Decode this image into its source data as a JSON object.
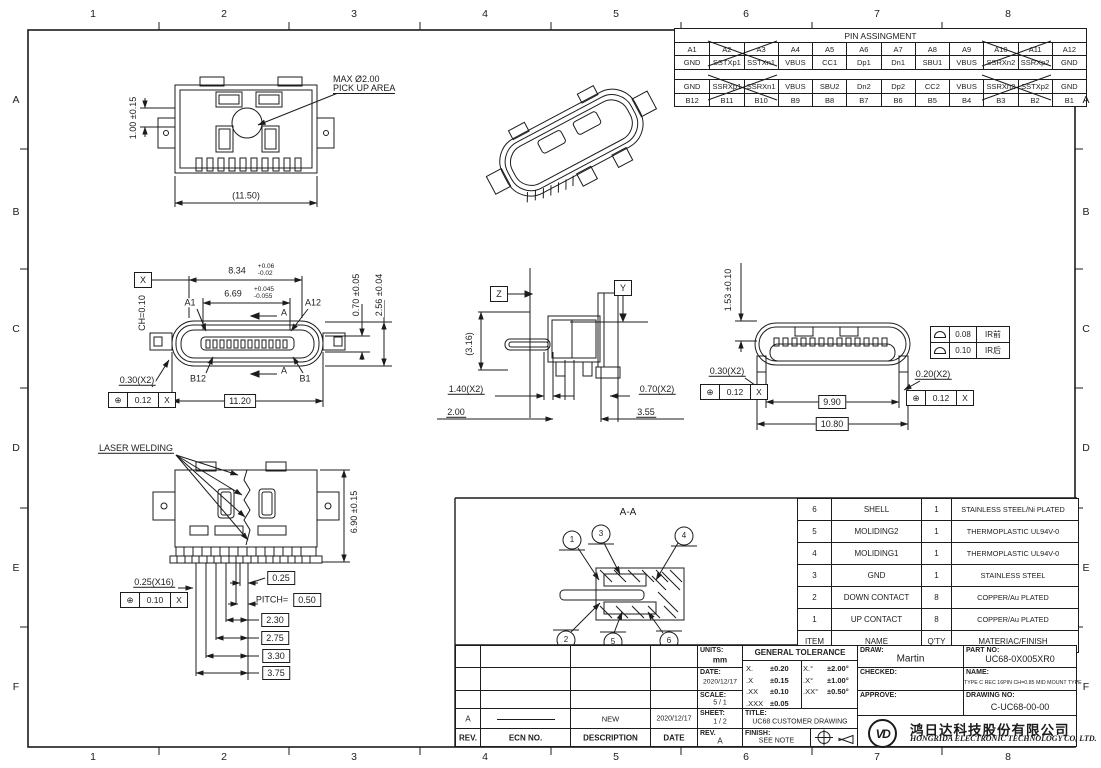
{
  "colors": {
    "line": "#1c1c1c",
    "bg": "#ffffff"
  },
  "border": {
    "cols": [
      "1",
      "2",
      "3",
      "4",
      "5",
      "6",
      "7",
      "8"
    ],
    "rows": [
      "A",
      "B",
      "C",
      "D",
      "E",
      "F"
    ]
  },
  "pin_table": {
    "title": "PIN ASSINGMENT",
    "top_pins": [
      "A1",
      "A2",
      "A3",
      "A4",
      "A5",
      "A6",
      "A7",
      "A8",
      "A9",
      "A10",
      "A11",
      "A12"
    ],
    "top_signals": [
      "GND",
      "SSTXp1",
      "SSTXn1",
      "VBUS",
      "CC1",
      "Dp1",
      "Dn1",
      "SBU1",
      "VBUS",
      "SSRXn2",
      "SSRXp2",
      "GND"
    ],
    "bottom_signals": [
      "GND",
      "SSRXp1",
      "SSRXn1",
      "VBUS",
      "SBU2",
      "Dn2",
      "Dp2",
      "CC2",
      "VBUS",
      "SSRXn2",
      "SSTXp2",
      "GND"
    ],
    "bottom_pins": [
      "B12",
      "B11",
      "B10",
      "B9",
      "B8",
      "B7",
      "B6",
      "B5",
      "B4",
      "B3",
      "B2",
      "B1"
    ]
  },
  "bom": {
    "headers": [
      "ITEM",
      "NAME",
      "Q'TY",
      "MATERIAC/FINISH"
    ],
    "rows": [
      [
        "6",
        "SHELL",
        "1",
        "STAINLESS STEEL/Ni PLATED"
      ],
      [
        "5",
        "MOLIDING2",
        "1",
        "THERMOPLASTIC  UL94V-0"
      ],
      [
        "4",
        "MOLIDING1",
        "1",
        "THERMOPLASTIC  UL94V-0"
      ],
      [
        "3",
        "GND",
        "1",
        "STAINLESS STEEL"
      ],
      [
        "2",
        "DOWN CONTACT",
        "8",
        "COPPER/Au PLATED"
      ],
      [
        "1",
        "UP CONTACT",
        "8",
        "COPPER/Au PLATED"
      ]
    ]
  },
  "title_block": {
    "units_label": "UNITS:",
    "units_value": "mm",
    "date_label": "DATE:",
    "date_value": "2020/12/17",
    "scale_label": "SCALE:",
    "scale_value": "5 / 1",
    "sheet_label": "SHEET:",
    "sheet_value": "1 / 2",
    "rev_label": "REV.",
    "rev_value": "A",
    "gt_title": "GENERAL TOLERANCE",
    "gt": [
      [
        "X.",
        "±0.20",
        "X.°",
        "±2.00°"
      ],
      [
        ".X",
        "±0.15",
        ".X°",
        "±1.00°"
      ],
      [
        ".XX",
        "±0.10",
        ".XX°",
        "±0.50°"
      ],
      [
        ".XXX",
        "±0.05",
        "",
        ""
      ]
    ],
    "title_label": "TITLE:",
    "title_value": "UC68 CUSTOMER DRAWING",
    "finish_label": "FINISH:",
    "finish_value": "SEE NOTE",
    "draw_label": "DRAW:",
    "draw_value": "Martin",
    "checked_label": "CHECKED:",
    "approve_label": "APPROVE:",
    "part_label": "PART NO:",
    "part_value": "UC68-0X005XR0",
    "name_label": "NAME:",
    "name_value": "TYPE C REC 16PIN CH=0.85 MID MOUNT TYPE",
    "dwg_label": "DRAWING NO:",
    "dwg_value": "C-UC68-00-00",
    "logo_text": "VD",
    "company_cn": "鸿日达科技股份有限公司",
    "company_en": "HONGRIDA ELECTRONIC TECHNOLOGY CO, LTD."
  },
  "revision": {
    "headers": [
      "REV.",
      "ECN NO.",
      "DESCRIPTION",
      "DATE"
    ],
    "row_rev": "A",
    "row_desc": "NEW",
    "row_date": "2020/12/17"
  },
  "ir_table": {
    "rows": [
      {
        "tol": "0.08",
        "zone": "IR前"
      },
      {
        "tol": "0.10",
        "zone": "IR后"
      }
    ]
  },
  "section": {
    "title": "A-A",
    "balloons": [
      "1",
      "2",
      "3",
      "4",
      "5",
      "6"
    ]
  },
  "views": {
    "top": {
      "note1": "MAX Ø2.00",
      "note2": "PICK UP AREA",
      "h": "1.00 ±0.15",
      "w": "(11.50)"
    },
    "front": {
      "datum": "X",
      "d1": "8.34",
      "d1u": "+0.06",
      "d1d": "-0.02",
      "d2": "6.69",
      "d2u": "+0.045",
      "d2d": "-0.055",
      "a1": "A1",
      "a12": "A12",
      "sec": "A",
      "ch": "CH=0.10",
      "d3": "0.70 ±0.05",
      "d4": "2.56 ±0.04",
      "b12": "B12",
      "b1": "B1",
      "d5": "0.30(X2)",
      "fcf_sym": "⊕",
      "fcf_val": "0.12",
      "fcf_dat": "X",
      "d6": "11.20"
    },
    "side": {
      "z": "Z",
      "y": "Y",
      "d1": "(3.16)",
      "d2": "1.40(X2)",
      "d3": "2.00",
      "d4": "0.70(X2)",
      "d5": "3.55"
    },
    "rear": {
      "d1": "1.53 ±0.10",
      "d2": "0.30(X2)",
      "fcf1_sym": "⊕",
      "fcf1_val": "0.12",
      "fcf1_dat": "X",
      "d3": "0.20(X2)",
      "fcf2_sym": "⊕",
      "fcf2_val": "0.12",
      "fcf2_dat": "X",
      "d4": "9.90",
      "d5": "10.80"
    },
    "bottom": {
      "label": "LASER WELDING",
      "d1": "6.90 ±0.15",
      "d2": "0.25(X16)",
      "fcf_sym": "⊕",
      "fcf_val": "0.10",
      "fcf_dat": "X",
      "d3": "0.25",
      "pitch_label": "PITCH=",
      "pitch_val": "0.50",
      "d4": "2.30",
      "d5": "2.75",
      "d6": "3.30",
      "d7": "3.75"
    }
  }
}
